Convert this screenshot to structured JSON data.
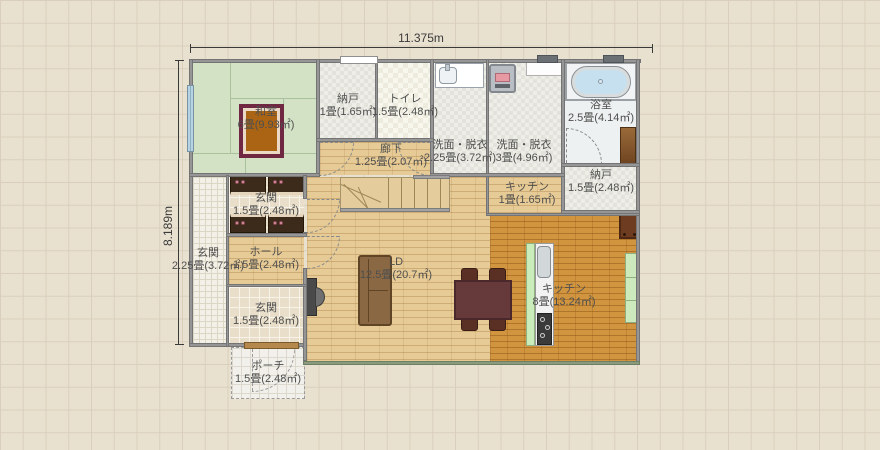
{
  "title": "floor-plan-editor-canvas",
  "dimensions": {
    "width_label": "11.375m",
    "height_label": "8.189m"
  },
  "rooms": {
    "washitsu": {
      "label": "和室",
      "area": "6畳(9.93㎡)"
    },
    "nando_top": {
      "label": "納戸",
      "area": "1畳(1.65㎡)"
    },
    "toilet": {
      "label": "トイレ",
      "area": "1.5畳(2.48㎡)"
    },
    "senmen1": {
      "label": "洗面・脱衣",
      "area": "2.25畳(3.72㎡)"
    },
    "senmen2": {
      "label": "洗面・脱衣",
      "area": "3畳(4.96㎡)"
    },
    "bathroom": {
      "label": "浴室",
      "area": "2.5畳(4.14㎡)"
    },
    "nando_right": {
      "label": "納戸",
      "area": "1.5畳(2.48㎡)"
    },
    "kitchen_small": {
      "label": "キッチン",
      "area": "1畳(1.65㎡)"
    },
    "rouka": {
      "label": "廊下",
      "area": "1.25畳(2.07㎡)"
    },
    "genkan_tile": {
      "label": "玄関",
      "area": "2.25畳(3.72㎡)"
    },
    "genkan_shoe": {
      "label": "玄関",
      "area": "1.5畳(2.48㎡)"
    },
    "hall": {
      "label": "ホール",
      "area": "1.5畳(2.48㎡)"
    },
    "genkan_lower": {
      "label": "玄関",
      "area": "1.5畳(2.48㎡)"
    },
    "porch": {
      "label": "ポーチ",
      "area": "1.5畳(2.48㎡)"
    },
    "ld": {
      "label": "LD",
      "area": "12.5畳(20.7㎡)"
    },
    "kitchen": {
      "label": "キッチン",
      "area": "8畳(13.24㎡)"
    }
  },
  "colors": {
    "canvas_bg": "#e9e1d0",
    "grid_line": "#d9cfbc",
    "wall_gray": "#969696",
    "tatami_green": "#d3e2c5",
    "wood_light": "#e7cb96",
    "wood_dark": "#d2953f",
    "counter_green": "#c9ecba",
    "bathtub_blue": "#c6e0ef",
    "table_maroon": "#5c3133",
    "sofa_brown": "#8a6844",
    "cabinet_brown": "#3c2a1a",
    "label_text": "#4f4f4f"
  }
}
